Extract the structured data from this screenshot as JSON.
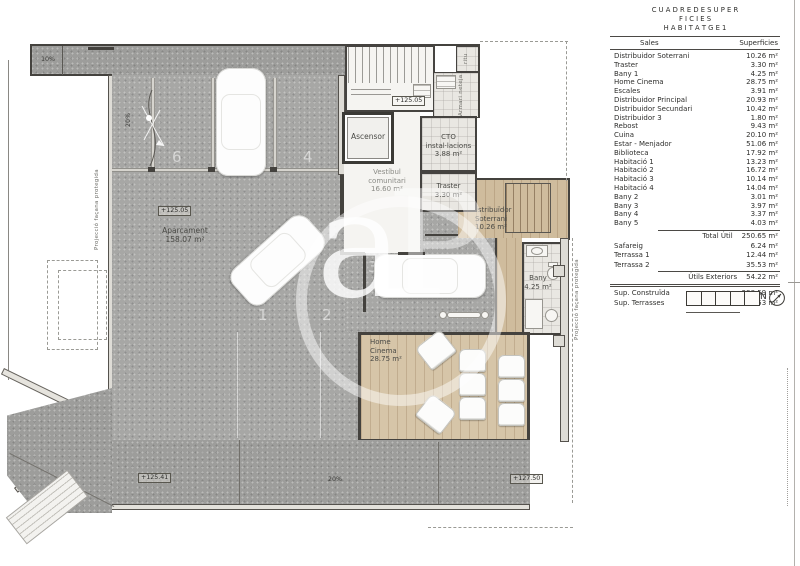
{
  "table": {
    "title_lines": [
      "C U A D R E   D E   S U P E R",
      "F I C I E S",
      "H A B I T A T G E   1"
    ],
    "col_label": "Sales",
    "col_value": "Superficies",
    "rows": [
      {
        "label": "Distribuidor Soterrani",
        "value": "10.26 m²"
      },
      {
        "label": "Traster",
        "value": "3.30 m²"
      },
      {
        "label": "Bany 1",
        "value": "4.25 m²"
      },
      {
        "label": "Home Cinema",
        "value": "28.75 m²"
      },
      {
        "label": "Escales",
        "value": "3.91 m²"
      },
      {
        "label": "Distribuidor Principal",
        "value": "20.93 m²"
      },
      {
        "label": "Distribuidor Secundari",
        "value": "10.42 m²"
      },
      {
        "label": "Distribuidor 3",
        "value": "1.80 m²"
      },
      {
        "label": "Rebost",
        "value": "9.43 m²"
      },
      {
        "label": "Cuina",
        "value": "20.10 m²"
      },
      {
        "label": "Estar - Menjador",
        "value": "51.06 m²"
      },
      {
        "label": "Biblioteca",
        "value": "17.92 m²"
      },
      {
        "label": "Habitació 1",
        "value": "13.23 m²"
      },
      {
        "label": "Habitació 2",
        "value": "16.72 m²"
      },
      {
        "label": "Habitació 3",
        "value": "10.14 m²"
      },
      {
        "label": "Habitació 4",
        "value": "14.04 m²"
      },
      {
        "label": "Bany 2",
        "value": "3.01 m²"
      },
      {
        "label": "Bany 3",
        "value": "3.97 m²"
      },
      {
        "label": "Bany 4",
        "value": "3.37 m²"
      },
      {
        "label": "Bany 5",
        "value": "4.03 m²"
      }
    ],
    "total_util": {
      "label": "Total Útil",
      "value": "250.65 m²"
    },
    "exterior_rows": [
      {
        "label": "Safareig",
        "value": "6.24 m²"
      },
      {
        "label": "Terrassa 1",
        "value": "12.44 m²"
      },
      {
        "label": "Terrassa 2",
        "value": "35.53 m²"
      }
    ],
    "utils_exteriors": {
      "label": "Útils Exteriors",
      "value": "54.22 m²"
    },
    "summary_rows": [
      {
        "label": "Sup. Construïda",
        "value": "298.59 m²"
      },
      {
        "label": "Sup. Terrasses",
        "value": "55.53 m²"
      }
    ]
  },
  "scalebar": {
    "ticks": [
      "0",
      "1",
      "2",
      "3",
      "4",
      "5"
    ],
    "north": "N"
  },
  "watermark": {
    "letter_a": "a",
    "letter_p": "P"
  },
  "plan": {
    "aparcament": {
      "lines": [
        "Aparcament",
        "158.07 m²"
      ]
    },
    "ascensor": {
      "label": "Ascensor"
    },
    "ritu": {
      "label": "ritu"
    },
    "armari": {
      "lines": [
        "Armari",
        "neteja"
      ]
    },
    "cto": {
      "lines": [
        "CTO",
        "instal·lacions",
        "3.88 m²"
      ]
    },
    "vestibul": {
      "lines": [
        "Vestíbul",
        "comunitari",
        "16.60 m²"
      ]
    },
    "traster": {
      "lines": [
        "Traster",
        "3.30 m²"
      ]
    },
    "distribuidor": {
      "lines": [
        "Distribuïdor",
        "Soterrani",
        "10.26 m²"
      ]
    },
    "bany": {
      "lines": [
        "Bany",
        "4.25 m²"
      ]
    },
    "home_cinema": {
      "lines": [
        "Home",
        "Cinema",
        "28.75 m²"
      ]
    },
    "levels": {
      "stairs": "+125.05",
      "parking": "+125.05",
      "terrace_low": "+125.41",
      "terrace_high": "+127.50"
    },
    "slopes": {
      "entry": "10%",
      "ramp": "20%",
      "driveway": "20%"
    },
    "space_numbers": [
      "6",
      "5",
      "4",
      "3",
      "1",
      "2"
    ],
    "projeccio_left": {
      "lines": [
        "Projecció façana",
        "protegida"
      ]
    },
    "projeccio_right": {
      "lines": [
        "Projecció façana",
        "protegida"
      ]
    }
  }
}
